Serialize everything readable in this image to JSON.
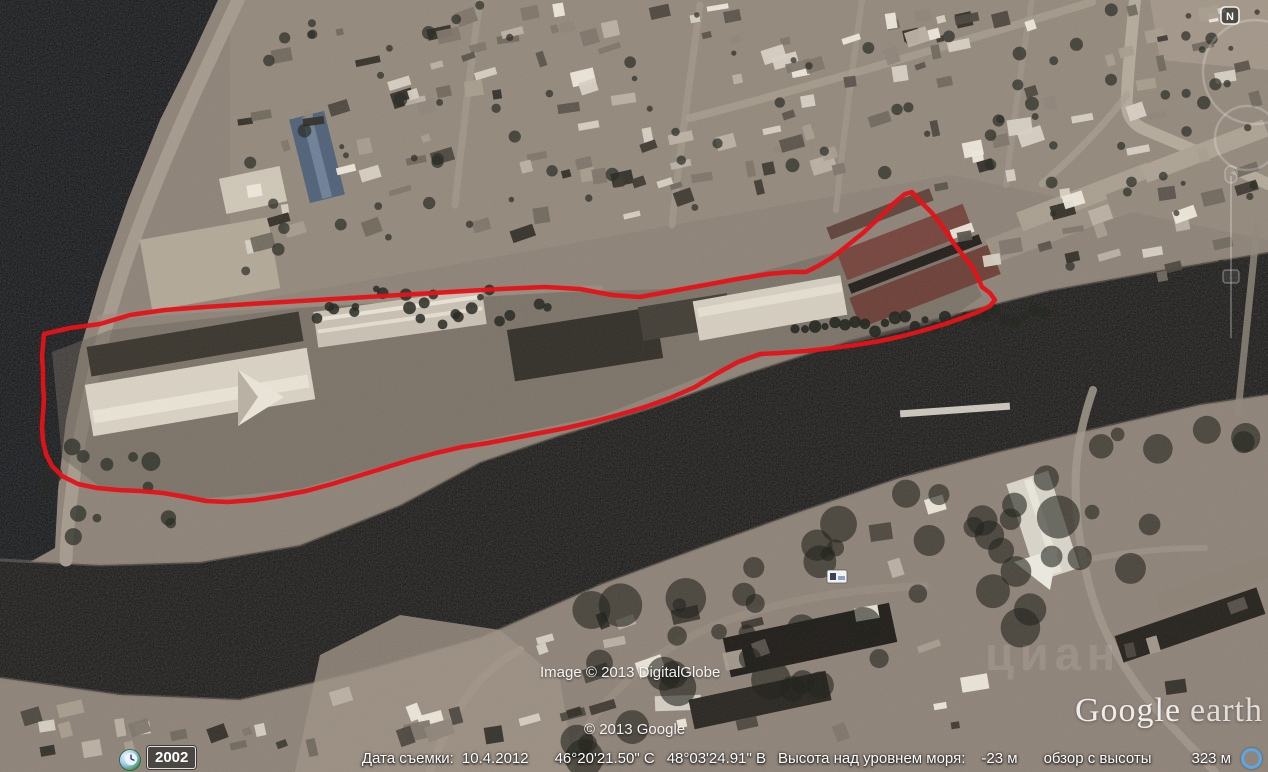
{
  "status_bar": {
    "capture_date_label": "Дата съемки:",
    "capture_date": "10.4.2012",
    "latitude": "46°20'21.50\" С",
    "longitude": "48°03'24.91\" В",
    "sea_level_label": "Высота над уровнем моря:",
    "sea_level_value": "-23 м",
    "eye_altitude_label": "обзор с высоты",
    "eye_altitude_value": "323 м"
  },
  "time_control": {
    "year": "2002"
  },
  "compass": {
    "north_label": "N"
  },
  "credits": {
    "imagery": "Image © 2013 DigitalGlobe",
    "google": "© 2013 Google"
  },
  "logo": {
    "google": "Google",
    "earth": "earth"
  },
  "watermark": {
    "text": "циан"
  },
  "annotation": {
    "outline_color": "#e41319",
    "style": "hand-drawn site outline"
  },
  "icons": {
    "clock": "clock-icon",
    "streaming": "streaming-indicator-icon",
    "north": "north-button",
    "lodging": "lodging-poi-icon"
  },
  "colors": {
    "outline": "#e41319",
    "status_text": "#ffffff",
    "streaming_ring": "#58a7e8"
  }
}
